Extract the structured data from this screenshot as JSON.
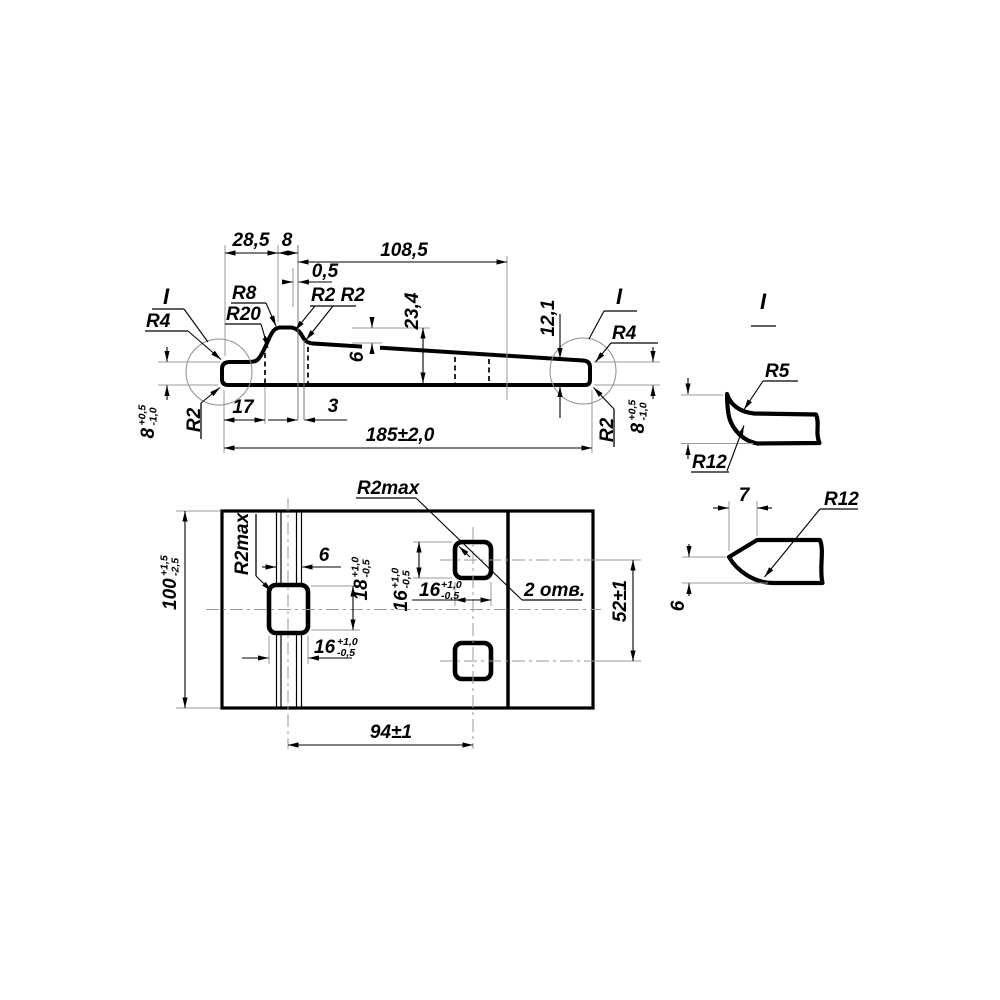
{
  "side_view": {
    "dim_28_5": "28,5",
    "dim_8_top": "8",
    "dim_108_5": "108,5",
    "dim_0_5": "0,5",
    "dim_23_4": "23,4",
    "dim_6_step": "6",
    "dim_12_1": "12,1",
    "dim_17": "17",
    "dim_3": "3",
    "dim_185": "185±2,0",
    "dim_8_left": "8",
    "dim_8_left_sup": "+0,5",
    "dim_8_left_sub": "-1,0",
    "dim_8_right": "8",
    "dim_8_right_sup": "+0,5",
    "dim_8_right_sub": "-1,0",
    "r4_left": "R4",
    "r20": "R20",
    "r8": "R8",
    "r2_r2": "R2 R2",
    "r2_left": "R2",
    "r4_right": "R4",
    "r2_right": "R2",
    "detail_ref_left": "I",
    "detail_ref_right": "I"
  },
  "plan_view": {
    "dim_100": "100",
    "dim_100_sup": "+1,5",
    "dim_100_sub": "-2,5",
    "r2max_left": "R2max",
    "r2max_top": "R2max",
    "dim_6_rib": "6",
    "dim_18": "18",
    "dim_18_sup": "+1,0",
    "dim_18_sub": "-0,5",
    "dim_16_left": "16",
    "dim_16_left_sup": "+1,0",
    "dim_16_left_sub": "-0,5",
    "dim_16_vert": "16",
    "dim_16_vert_sup": "+1,0",
    "dim_16_vert_sub": "-0,5",
    "dim_16_horiz": "16",
    "dim_16_horiz_sup": "+1,0",
    "dim_16_horiz_sub": "-0,5",
    "holes_note": "2 отв.",
    "dim_52": "52±1",
    "dim_94": "94±1"
  },
  "detail_i": {
    "title": "I",
    "r5": "R5",
    "r12": "R12"
  },
  "detail_end": {
    "dim_7": "7",
    "r12": "R12",
    "dim_6": "6"
  }
}
